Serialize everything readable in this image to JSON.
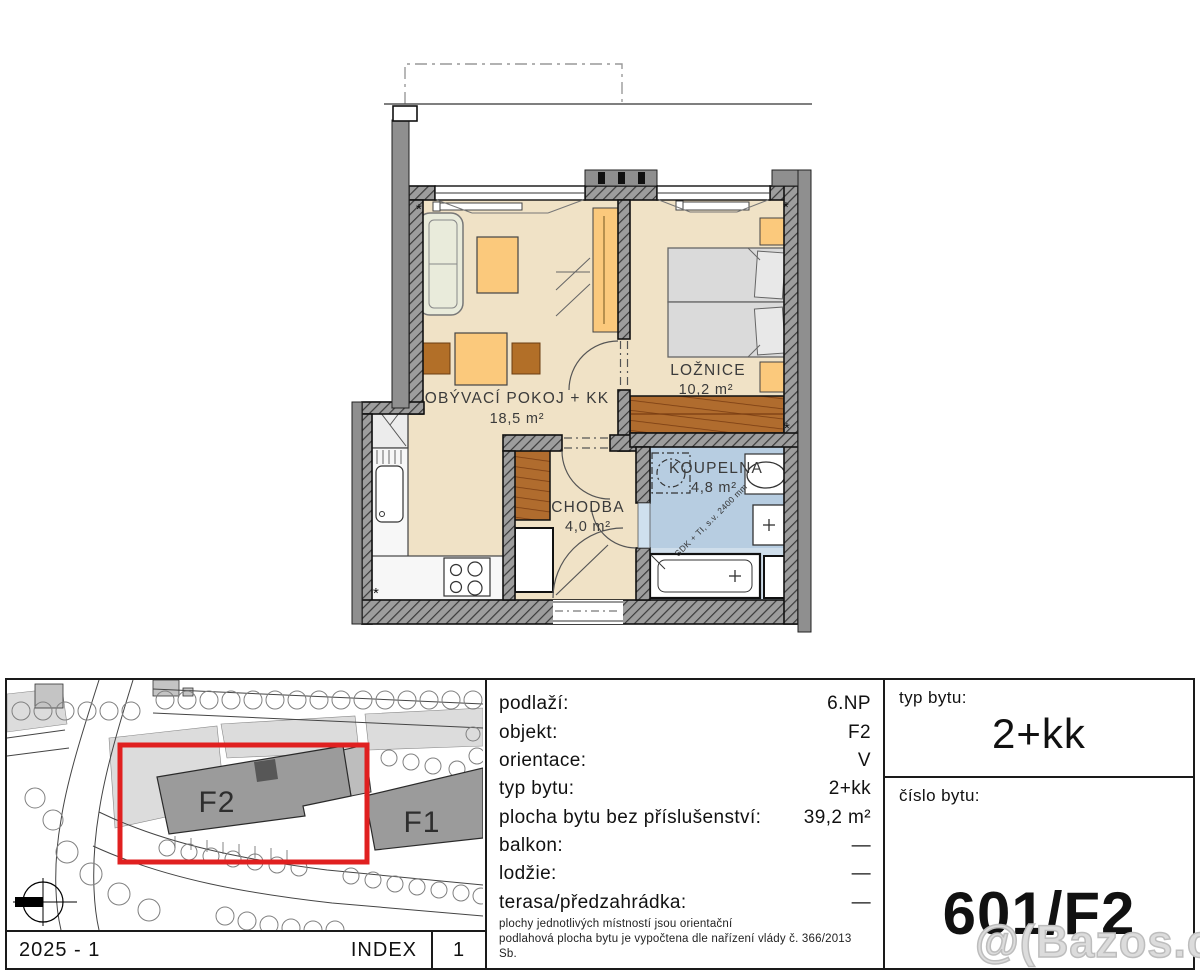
{
  "floorplan": {
    "rooms": {
      "living": {
        "name": "OBÝVACÍ POKOJ + KK",
        "area": "18,5 m²"
      },
      "bedroom": {
        "name": "LOŽNICE",
        "area": "10,2 m²"
      },
      "hall": {
        "name": "CHODBA",
        "area": "4,0 m²"
      },
      "bath": {
        "name": "KOUPELNA",
        "area": "4,8 m²"
      }
    },
    "bath_note": "SDK + TI, s.v. 2400 mm"
  },
  "siteplan": {
    "building_highlight": "F2",
    "building_other": "F1",
    "highlight_color": "#e02020"
  },
  "footer": {
    "revision": "2025 - 1",
    "index_label": "INDEX",
    "index_value": "1"
  },
  "details": {
    "rows": [
      {
        "label": "podlaží:",
        "value": "6.NP"
      },
      {
        "label": "objekt:",
        "value": "F2"
      },
      {
        "label": "orientace:",
        "value": "V"
      },
      {
        "label": "typ bytu:",
        "value": "2+kk"
      },
      {
        "label": "plocha bytu bez příslušenství:",
        "value": "39,2 m²"
      },
      {
        "label": "balkon:",
        "value": "—"
      },
      {
        "label": "lodžie:",
        "value": "—"
      },
      {
        "label": "terasa/předzahrádka:",
        "value": "—"
      }
    ],
    "note_line1": "plochy jednotlivých místností jsou orientační",
    "note_line2": "podlahová plocha bytu je vypočtena dle nařízení vlády č. 366/2013 Sb."
  },
  "summary": {
    "type_label": "typ bytu:",
    "type_value": "2+kk",
    "number_label": "číslo bytu:",
    "number_value": "601/F2"
  },
  "watermark": "@(Bazos.cz"
}
